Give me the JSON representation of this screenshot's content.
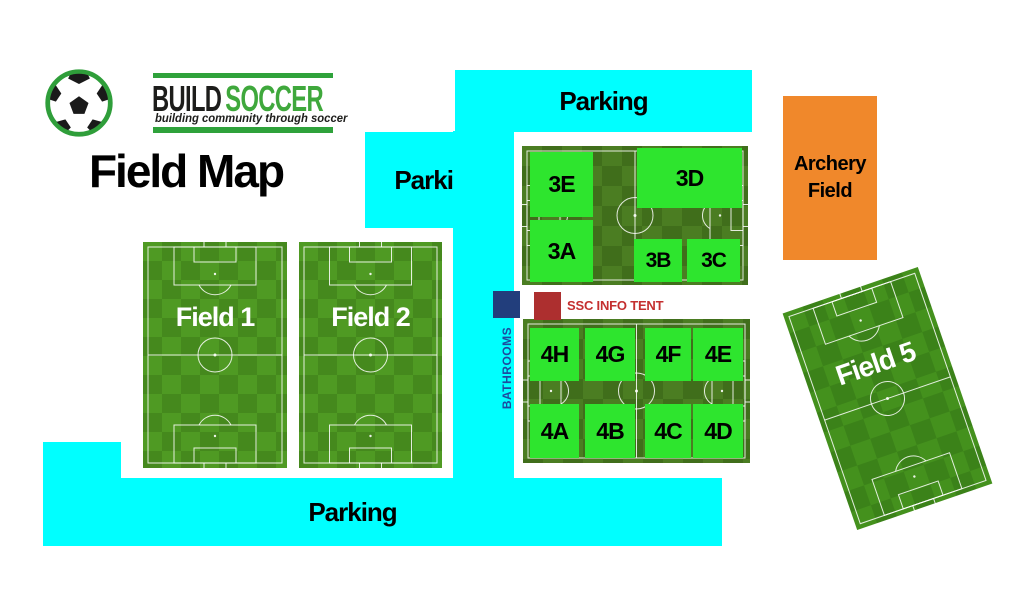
{
  "logo": {
    "brand_build": "BUILD",
    "brand_soccer": "SOCCER",
    "tagline": "building community through soccer"
  },
  "title": "Field Map",
  "parking": {
    "top": "Parking",
    "left": "Parking",
    "bottom": "Parking"
  },
  "field1": "Field 1",
  "field2": "Field 2",
  "field5": "Field 5",
  "complex3": {
    "subfields": [
      {
        "label": "3E"
      },
      {
        "label": "3D"
      },
      {
        "label": "3A"
      },
      {
        "label": "3B"
      },
      {
        "label": "3C"
      }
    ]
  },
  "complex4": {
    "subfields": [
      {
        "label": "4H"
      },
      {
        "label": "4G"
      },
      {
        "label": "4F"
      },
      {
        "label": "4E"
      },
      {
        "label": "4A"
      },
      {
        "label": "4B"
      },
      {
        "label": "4C"
      },
      {
        "label": "4D"
      }
    ]
  },
  "bathrooms": {
    "label": "BATHROOMS"
  },
  "info_tent": {
    "label": "SSC INFO TENT"
  },
  "archery": {
    "line1": "Archery",
    "line2": "Field"
  },
  "colors": {
    "parking_cyan": "#00ffff",
    "subfield_green": "#2ee52e",
    "archery_orange": "#f0882b",
    "bathrooms_blue": "#223e7c",
    "info_tent_red": "#ad2f2f",
    "logo_green": "#3fa83c",
    "field_label_white": "#ffffff"
  }
}
